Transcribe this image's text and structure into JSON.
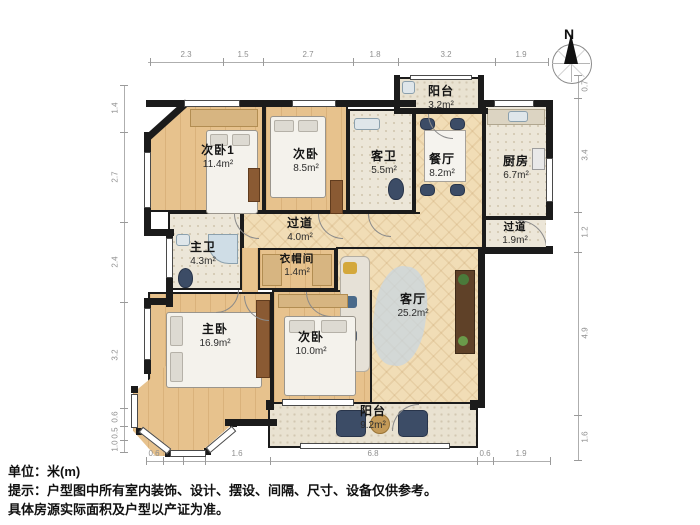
{
  "meta": {
    "north": "N",
    "unit_label": "单位：米(m)",
    "tip_line1": "提示：户型图中所有室内装饰、设计、摆设、间隔、尺寸、设备仅供参考。",
    "tip_line2": "具体房源实际面积及户型以产证为准。"
  },
  "rooms": [
    {
      "name": "次卧1",
      "area": "11.4m²"
    },
    {
      "name": "次卧",
      "area": "8.5m²"
    },
    {
      "name": "客卫",
      "area": "5.5m²"
    },
    {
      "name": "餐厅",
      "area": "8.2m²"
    },
    {
      "name": "厨房",
      "area": "6.7m²"
    },
    {
      "name": "阳台",
      "area": "3.2m²"
    },
    {
      "name": "过道",
      "area": "4.0m²"
    },
    {
      "name": "过道",
      "area": "1.9m²"
    },
    {
      "name": "主卫",
      "area": "4.3m²"
    },
    {
      "name": "衣帽间",
      "area": "1.4m²"
    },
    {
      "name": "客厅",
      "area": "25.2m²"
    },
    {
      "name": "主卧",
      "area": "16.9m²"
    },
    {
      "name": "次卧",
      "area": "10.0m²"
    },
    {
      "name": "阳台",
      "area": "9.2m²"
    }
  ],
  "dimensions": {
    "top": [
      "2.3",
      "1.5",
      "2.7",
      "1.8",
      "3.2",
      "1.9"
    ],
    "bottom": [
      "0.6",
      "0.9",
      "0.7",
      "1.6",
      "6.8",
      "0.6",
      "1.9"
    ],
    "left": [
      "1.4",
      "2.7",
      "2.4",
      "3.2",
      "0.6",
      "0.5",
      "1.0"
    ],
    "right": [
      "0.7",
      "3.4",
      "1.2",
      "4.9",
      "1.6"
    ]
  },
  "colors": {
    "wall": "#1b1b1b",
    "wood_floor": "#e7c28d",
    "herringbone_floor": "#f1ddb6",
    "tile_floor": "#ece6d8",
    "accent_furniture": "#3c4c66"
  }
}
